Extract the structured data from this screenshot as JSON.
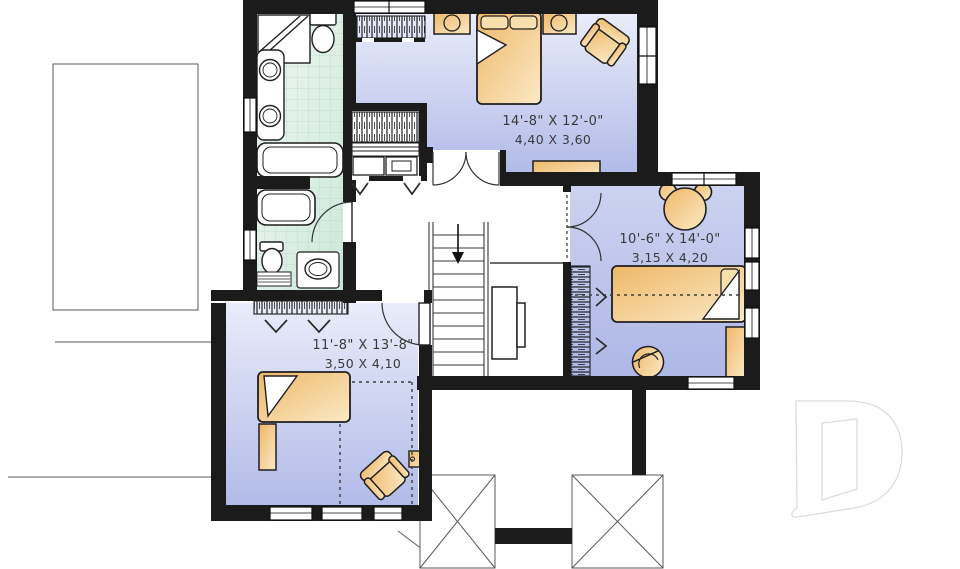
{
  "canvas": {
    "width": 960,
    "height": 569
  },
  "rooms": [
    {
      "name": "master-bedroom",
      "dim_imperial": "14'-8\" X 12'-0\"",
      "dim_metric": "4,40 X 3,60"
    },
    {
      "name": "kids-bedroom",
      "dim_imperial": "10'-6\" X 14'-0\"",
      "dim_metric": "3,15 X 4,20"
    },
    {
      "name": "front-bedroom",
      "dim_imperial": "11'-8\" X 13'-8\"",
      "dim_metric": "3,50 X 4,10"
    }
  ],
  "fixtures": [
    "corner-shower",
    "toilet",
    "double-vanity-sinks",
    "bathtub",
    "second-bathtub",
    "toilet-2",
    "sink-2",
    "double-bed",
    "twin-bed",
    "kids-bed",
    "nightstand",
    "lamp",
    "armchair",
    "dresser",
    "teddy-bear-rug",
    "closet-hanging-rod",
    "staircase-down",
    "french-doors",
    "bifold-doors",
    "window"
  ],
  "palette": {
    "wall": "#1b1b1b",
    "bedroom_floor_light": "#e7eaf9",
    "bedroom_floor_dark": "#b2bbe8",
    "bath_floor_light": "#eef7f1",
    "bath_floor_dark": "#cfe9db",
    "furniture_dark": "#edb766",
    "furniture_light": "#fbe7c3",
    "label_text": "#3a3a3a",
    "roof_line": "#5a5a5a",
    "watermark_line": "#dcdcdc"
  }
}
